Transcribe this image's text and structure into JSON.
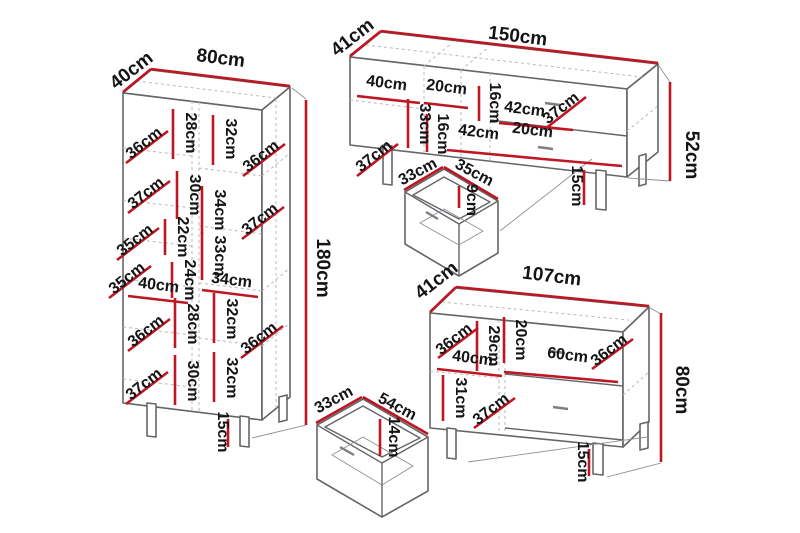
{
  "colors": {
    "dimension_line": "#be1622",
    "furniture_outline": "#636568",
    "dashed_line": "#b7babd",
    "background": "#ffffff",
    "text": "#141414"
  },
  "cabinet": {
    "width": "80cm",
    "depth": "40cm",
    "height": "180cm",
    "leg": "15cm",
    "inner": [
      "36cm",
      "28cm",
      "32cm",
      "36cm",
      "37cm",
      "30cm",
      "22cm",
      "34cm",
      "35cm",
      "33cm",
      "37cm",
      "24cm",
      "35cm",
      "40cm",
      "34cm",
      "28cm",
      "32cm",
      "36cm",
      "36cm",
      "30cm",
      "32cm",
      "37cm"
    ]
  },
  "tv_stand": {
    "width": "150cm",
    "depth": "41cm",
    "height": "52cm",
    "leg": "15cm",
    "inner": [
      "40cm",
      "20cm",
      "16cm",
      "42cm",
      "37cm",
      "37cm",
      "33cm",
      "16cm",
      "42cm",
      "20cm"
    ]
  },
  "tv_drawer": {
    "depth": "33cm",
    "width": "35cm",
    "height": "9cm"
  },
  "sideboard": {
    "width": "107cm",
    "depth": "41cm",
    "height": "80cm",
    "leg": "15cm",
    "inner": [
      "36cm",
      "29cm",
      "20cm",
      "40cm",
      "60cm",
      "36cm",
      "31cm",
      "37cm"
    ]
  },
  "sideboard_drawer": {
    "depth": "33cm",
    "width": "54cm",
    "height": "14cm"
  }
}
